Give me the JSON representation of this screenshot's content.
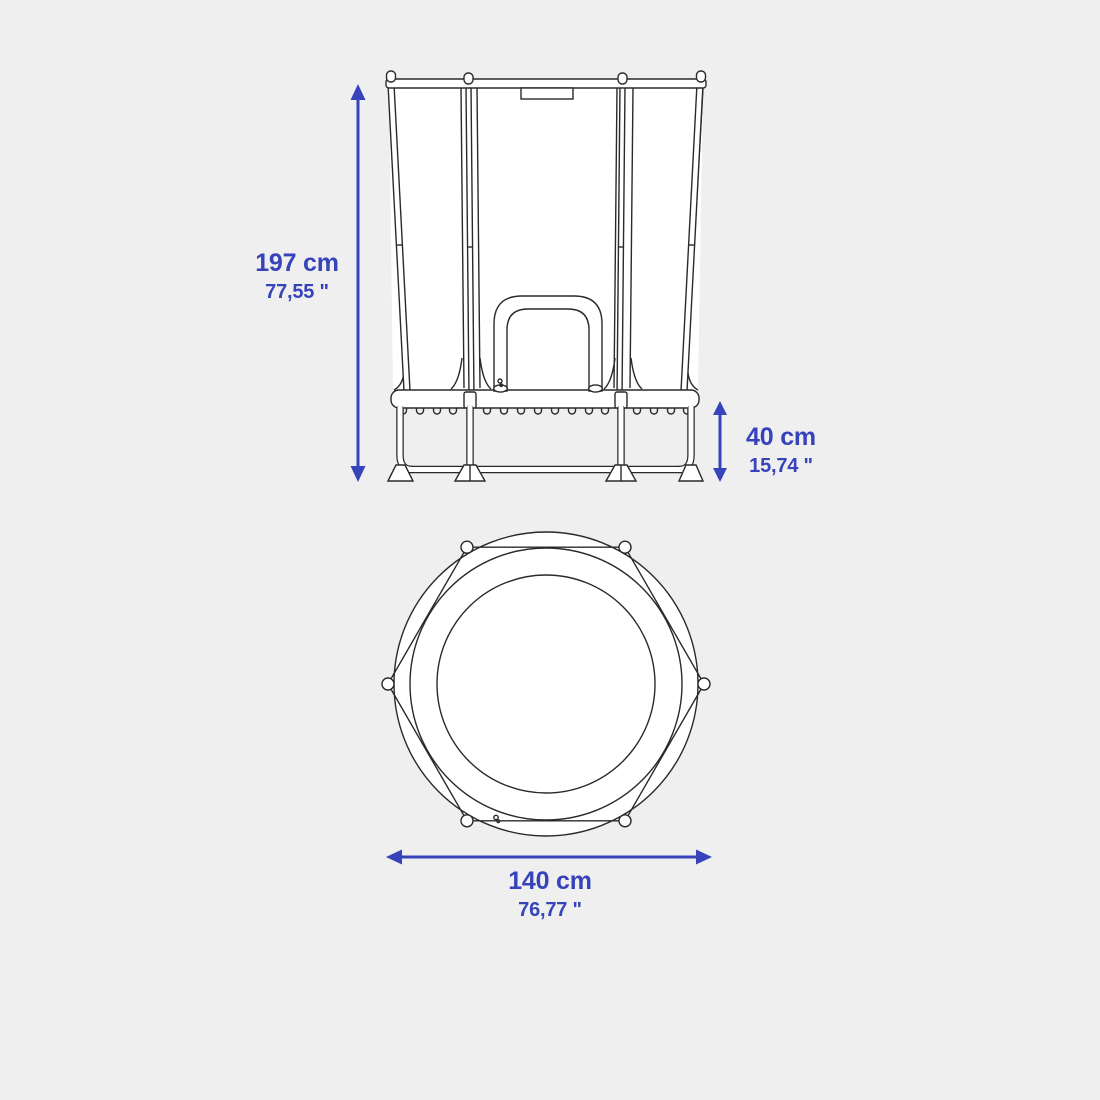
{
  "colors": {
    "background": "#efefef",
    "accent": "#3643ba",
    "line": "#2a2a2a",
    "drawing_fill": "#ffffff"
  },
  "icons": {
    "height_arrow": "double-headed-vertical-arrow",
    "frame_height_arrow": "double-headed-vertical-arrow",
    "diameter_arrow": "double-headed-horizontal-arrow"
  },
  "dimensions": {
    "total_height": {
      "metric": "197 cm",
      "imperial": "77,55 \""
    },
    "frame_height": {
      "metric": "40 cm",
      "imperial": "15,74 \""
    },
    "diameter": {
      "metric": "140 cm",
      "imperial": "76,77 \""
    }
  }
}
